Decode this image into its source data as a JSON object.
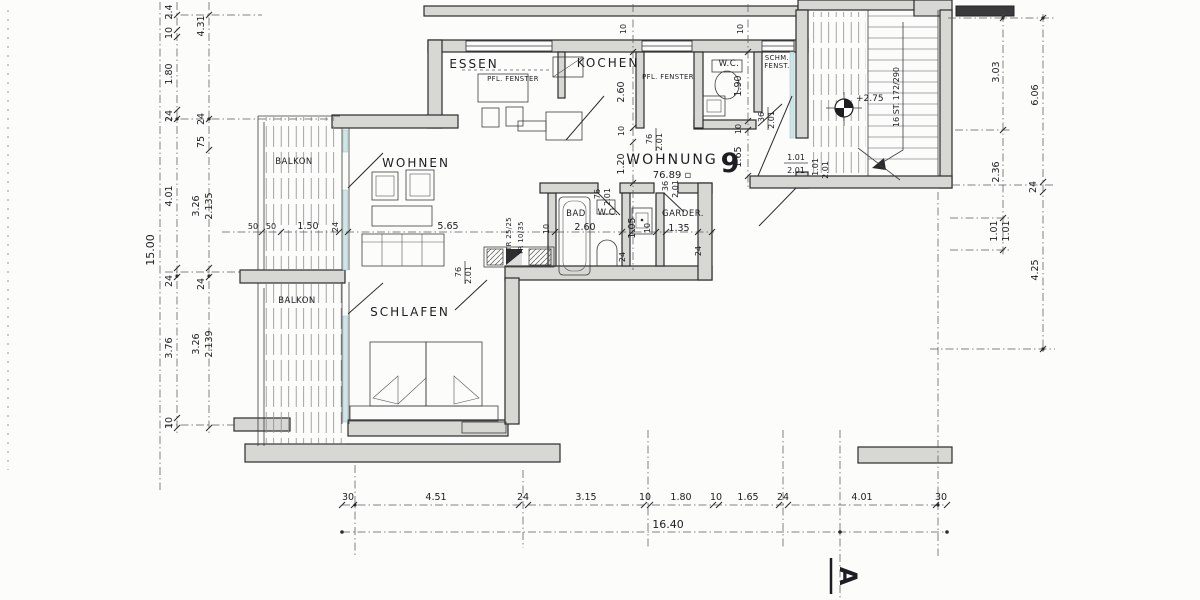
{
  "plan": {
    "apartment_label": "WOHNUNG",
    "apartment_number": "9",
    "apartment_area": "76.89 ▫",
    "rooms": {
      "essen": "ESSEN",
      "kochen": "KOCHEN",
      "wohnen": "WOHNEN",
      "schlafen": "SCHLAFEN",
      "bad": "BAD",
      "wc_top": "W.C.",
      "wc_mid": "W.C.",
      "garderobe": "GARDER.",
      "balkon_upper": "BALKON",
      "balkon_lower": "BALKON"
    },
    "annotations": {
      "stairs": "16 ST. 172/290",
      "level": "+2.75",
      "tr_1": "TR 25/25",
      "tr_2": "TR 10/35",
      "fenster_essen": "PFL. FENSTER",
      "fenster_kochen": "PFL. FENSTER",
      "schm_fenster_1": "SCHM.",
      "schm_fenster_2": "FENST.",
      "section_marker": "A"
    }
  },
  "dims": {
    "left_outer": "15.00",
    "left_a": [
      "2.4",
      "10",
      "1.80",
      "24",
      "4.01",
      "24",
      "3.76",
      "10"
    ],
    "left_b": [
      "4.31",
      "24",
      "75",
      "3.26",
      "2.135",
      "24",
      "3.26",
      "2.139"
    ],
    "right_a": [
      "3.03",
      "2.36",
      "1.01",
      "1.01"
    ],
    "right_b": [
      "6.06",
      "24",
      "4.25"
    ],
    "bottom": [
      "30",
      "4.51",
      "24",
      "3.15",
      "10",
      "1.80",
      "10",
      "1.65",
      "24",
      "4.01",
      "30"
    ],
    "bottom_total": "16.40",
    "inner": {
      "wall_top_1": "10",
      "wall_top_2": "10",
      "kochen_depth": "2.60",
      "kochen_wall": "10",
      "flur_width": "1.20",
      "wohnen_width": "5.65",
      "wohnen_wall": "10",
      "balkon_50a": "50",
      "balkon_50b": "50",
      "balkon_150": "1.50",
      "balkon_24": "24",
      "wc_width": "1.90",
      "hall_wall": "10",
      "hall_width": "1.65",
      "bad_width": "2.60",
      "wc_mid_width": "1.05",
      "wc_mid_wall": "10",
      "bad_wall_a": "24",
      "bad_wall_b": "24",
      "garderobe_width": "1.35"
    },
    "doors": {
      "w76": "76",
      "w36": "36",
      "h201": "2.01",
      "entry_w": "1.01",
      "entry_h": "2.01"
    }
  }
}
